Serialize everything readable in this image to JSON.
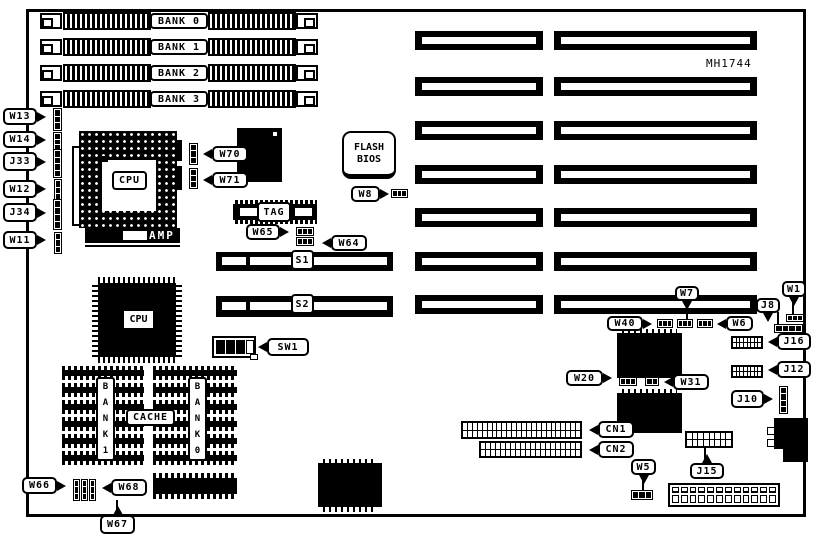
{
  "diagram": {
    "part_number": "MH1744",
    "cpu_socket": {
      "label": "CPU",
      "brand": "AMP"
    },
    "cpu_chip": {
      "label": "CPU"
    },
    "flash_bios": {
      "line1": "FLASH",
      "line2": "BIOS"
    },
    "tag_chip": {
      "label": "TAG"
    },
    "cache": {
      "label": "CACHE",
      "bank_left": "BANK 1",
      "bank_right": "BANK 0"
    },
    "bus_slots": {
      "s1": "S1",
      "s2": "S2"
    },
    "simm": {
      "x": 40,
      "w": 278,
      "h": 18,
      "rows_y": [
        12,
        38,
        64,
        90
      ],
      "banks": [
        "BANK 0",
        "BANK 1",
        "BANK 2",
        "BANK 3"
      ]
    },
    "expansion_slots": {
      "rows_y": [
        31,
        77,
        121,
        165,
        208,
        252,
        295
      ],
      "h": 19,
      "left": {
        "x": 415,
        "w": 128
      },
      "right": {
        "x": 554,
        "w": 203
      }
    },
    "cache_groups": [
      {
        "id": "cache-bank1-chips",
        "x": 62,
        "w": 82,
        "rows_y": [
          366,
          383,
          400,
          417,
          434,
          451
        ],
        "row_h": 14
      },
      {
        "id": "cache-bank0-chips",
        "x": 153,
        "w": 84,
        "rows_y": [
          366,
          383,
          400,
          417,
          434,
          451
        ],
        "row_h": 14
      },
      {
        "id": "cache-extra-chip",
        "x": 153,
        "w": 84,
        "rows_y": [
          473
        ],
        "row_h": 26
      }
    ],
    "callouts": [
      {
        "id": "w13",
        "text": "W13",
        "x": 3,
        "y": 108,
        "w": 34,
        "h": 17,
        "ptr": "right"
      },
      {
        "id": "w14",
        "text": "W14",
        "x": 3,
        "y": 131,
        "w": 34,
        "h": 17,
        "ptr": "right"
      },
      {
        "id": "j33",
        "text": "J33",
        "x": 3,
        "y": 152,
        "w": 34,
        "h": 19,
        "ptr": "right"
      },
      {
        "id": "w12",
        "text": "W12",
        "x": 3,
        "y": 180,
        "w": 34,
        "h": 18,
        "ptr": "right"
      },
      {
        "id": "j34",
        "text": "J34",
        "x": 3,
        "y": 203,
        "w": 34,
        "h": 19,
        "ptr": "right"
      },
      {
        "id": "w11",
        "text": "W11",
        "x": 3,
        "y": 231,
        "w": 34,
        "h": 18,
        "ptr": "right"
      },
      {
        "id": "w70",
        "text": "W70",
        "x": 212,
        "y": 146,
        "w": 36,
        "h": 16,
        "ptr": "left"
      },
      {
        "id": "w71",
        "text": "W71",
        "x": 212,
        "y": 172,
        "w": 36,
        "h": 16,
        "ptr": "left"
      },
      {
        "id": "w8",
        "text": "W8",
        "x": 351,
        "y": 186,
        "w": 29,
        "h": 16,
        "ptr": "right"
      },
      {
        "id": "w65",
        "text": "W65",
        "x": 246,
        "y": 224,
        "w": 34,
        "h": 16,
        "ptr": "right"
      },
      {
        "id": "w64",
        "text": "W64",
        "x": 331,
        "y": 235,
        "w": 36,
        "h": 16,
        "ptr": "left"
      },
      {
        "id": "sw1",
        "text": "SW1",
        "x": 267,
        "y": 338,
        "w": 42,
        "h": 18,
        "ptr": "left"
      },
      {
        "id": "w66",
        "text": "W66",
        "x": 22,
        "y": 477,
        "w": 35,
        "h": 17,
        "ptr": "right"
      },
      {
        "id": "w68",
        "text": "W68",
        "x": 111,
        "y": 479,
        "w": 36,
        "h": 17,
        "ptr": "left"
      },
      {
        "id": "w67",
        "text": "W67",
        "x": 100,
        "y": 515,
        "w": 35,
        "h": 19,
        "ptr": "up"
      },
      {
        "id": "w40",
        "text": "W40",
        "x": 607,
        "y": 316,
        "w": 36,
        "h": 15,
        "ptr": "right"
      },
      {
        "id": "w7",
        "text": "W7",
        "x": 675,
        "y": 286,
        "w": 24,
        "h": 15,
        "ptr": "down"
      },
      {
        "id": "w6",
        "text": "W6",
        "x": 726,
        "y": 316,
        "w": 27,
        "h": 15,
        "ptr": "left"
      },
      {
        "id": "w1",
        "text": "W1",
        "x": 782,
        "y": 281,
        "w": 24,
        "h": 16,
        "ptr": "down"
      },
      {
        "id": "j8",
        "text": "J8",
        "x": 756,
        "y": 298,
        "w": 24,
        "h": 15,
        "ptr": "down"
      },
      {
        "id": "j16",
        "text": "J16",
        "x": 777,
        "y": 333,
        "w": 34,
        "h": 17,
        "ptr": "left"
      },
      {
        "id": "j12",
        "text": "J12",
        "x": 777,
        "y": 361,
        "w": 34,
        "h": 17,
        "ptr": "left"
      },
      {
        "id": "w20",
        "text": "W20",
        "x": 566,
        "y": 370,
        "w": 37,
        "h": 16,
        "ptr": "right"
      },
      {
        "id": "w31",
        "text": "W31",
        "x": 673,
        "y": 374,
        "w": 36,
        "h": 16,
        "ptr": "left"
      },
      {
        "id": "j10",
        "text": "J10",
        "x": 731,
        "y": 390,
        "w": 33,
        "h": 18,
        "ptr": "right"
      },
      {
        "id": "cn1",
        "text": "CN1",
        "x": 598,
        "y": 421,
        "w": 36,
        "h": 17,
        "ptr": "left"
      },
      {
        "id": "cn2",
        "text": "CN2",
        "x": 598,
        "y": 441,
        "w": 36,
        "h": 17,
        "ptr": "left"
      },
      {
        "id": "w5",
        "text": "W5",
        "x": 631,
        "y": 459,
        "w": 25,
        "h": 16,
        "ptr": "down"
      },
      {
        "id": "j15",
        "text": "J15",
        "x": 690,
        "y": 463,
        "w": 34,
        "h": 16,
        "ptr": "up"
      }
    ],
    "jumpers": [
      {
        "id": "w13-jumper",
        "x": 53,
        "y": 108,
        "w": 9,
        "h": 23,
        "orient": "v",
        "pins": 3
      },
      {
        "id": "w14-jumper",
        "x": 53,
        "y": 132,
        "w": 9,
        "h": 20,
        "orient": "v",
        "pins": 3
      },
      {
        "id": "j33-jumper",
        "x": 53,
        "y": 149,
        "w": 9,
        "h": 29,
        "orient": "v",
        "pins": 4
      },
      {
        "id": "w12-jumper",
        "x": 54,
        "y": 179,
        "w": 8,
        "h": 23,
        "orient": "v",
        "pins": 3
      },
      {
        "id": "j34-jumper",
        "x": 53,
        "y": 199,
        "w": 9,
        "h": 31,
        "orient": "v",
        "pins": 4
      },
      {
        "id": "w11-jumper",
        "x": 54,
        "y": 232,
        "w": 8,
        "h": 22,
        "orient": "v",
        "pins": 3
      },
      {
        "id": "w70-jumper",
        "x": 189,
        "y": 143,
        "w": 9,
        "h": 22,
        "orient": "v",
        "pins": 3
      },
      {
        "id": "w71-jumper",
        "x": 189,
        "y": 168,
        "w": 9,
        "h": 21,
        "orient": "v",
        "pins": 3
      },
      {
        "id": "w8-jumper",
        "x": 391,
        "y": 189,
        "w": 17,
        "h": 9,
        "orient": "h",
        "pins": 3
      },
      {
        "id": "w65-jumper",
        "x": 296,
        "y": 227,
        "w": 18,
        "h": 9,
        "orient": "h",
        "pins": 3
      },
      {
        "id": "w64-jumper",
        "x": 296,
        "y": 237,
        "w": 18,
        "h": 9,
        "orient": "h",
        "pins": 3
      },
      {
        "id": "w40-jumper",
        "x": 657,
        "y": 319,
        "w": 16,
        "h": 9,
        "orient": "h",
        "pins": 3
      },
      {
        "id": "w7-jumper",
        "x": 677,
        "y": 319,
        "w": 16,
        "h": 9,
        "orient": "h",
        "pins": 3
      },
      {
        "id": "w6-jumper",
        "x": 697,
        "y": 319,
        "w": 16,
        "h": 9,
        "orient": "h",
        "pins": 3
      },
      {
        "id": "w1-jumper",
        "x": 786,
        "y": 314,
        "w": 18,
        "h": 8,
        "orient": "h",
        "pins": 3
      },
      {
        "id": "j8-jumper",
        "x": 774,
        "y": 324,
        "w": 29,
        "h": 9,
        "orient": "h",
        "pins": 4
      },
      {
        "id": "w20-jumper",
        "x": 619,
        "y": 377,
        "w": 18,
        "h": 9,
        "orient": "h",
        "pins": 3
      },
      {
        "id": "w31-jumper",
        "x": 645,
        "y": 377,
        "w": 14,
        "h": 9,
        "orient": "h",
        "pins": 2
      },
      {
        "id": "j10-jumper",
        "x": 779,
        "y": 386,
        "w": 9,
        "h": 28,
        "orient": "v",
        "pins": 4
      },
      {
        "id": "w5-jumper",
        "x": 631,
        "y": 490,
        "w": 22,
        "h": 10,
        "orient": "h",
        "pins": 3
      },
      {
        "id": "w66-jumper-a",
        "x": 73,
        "y": 479,
        "w": 7,
        "h": 22,
        "orient": "v",
        "pins": 3
      },
      {
        "id": "w66-jumper-b",
        "x": 81,
        "y": 479,
        "w": 7,
        "h": 22,
        "orient": "v",
        "pins": 3
      },
      {
        "id": "w66-jumper-c",
        "x": 89,
        "y": 479,
        "w": 7,
        "h": 22,
        "orient": "v",
        "pins": 3
      }
    ],
    "lines": [
      {
        "id": "w7-line",
        "x": 686,
        "y": 300,
        "w": 2,
        "h": 20
      },
      {
        "id": "w1-line",
        "x": 792,
        "y": 296,
        "w": 2,
        "h": 19
      },
      {
        "id": "j8-line",
        "x": 777,
        "y": 312,
        "w": 2,
        "h": 13
      },
      {
        "id": "w5-line",
        "x": 642,
        "y": 474,
        "w": 2,
        "h": 17
      },
      {
        "id": "w67-line",
        "x": 116,
        "y": 500,
        "w": 2,
        "h": 16
      },
      {
        "id": "j15-line",
        "x": 704,
        "y": 447,
        "w": 2,
        "h": 17
      }
    ],
    "pin_headers": [
      {
        "id": "cn1-connector",
        "x": 461,
        "y": 421,
        "w": 121,
        "h": 18,
        "cols": 24
      },
      {
        "id": "cn2-connector",
        "x": 479,
        "y": 441,
        "w": 103,
        "h": 17,
        "cols": 20
      },
      {
        "id": "j16-header",
        "x": 731,
        "y": 336,
        "w": 32,
        "h": 13,
        "cols": 8
      },
      {
        "id": "j12-header",
        "x": 731,
        "y": 365,
        "w": 32,
        "h": 13,
        "cols": 8
      },
      {
        "id": "j15-header",
        "x": 685,
        "y": 431,
        "w": 48,
        "h": 17,
        "cols": 8
      }
    ],
    "power_connector": {
      "x": 668,
      "y": 483,
      "w": 112,
      "h": 24,
      "pins": 12
    }
  }
}
